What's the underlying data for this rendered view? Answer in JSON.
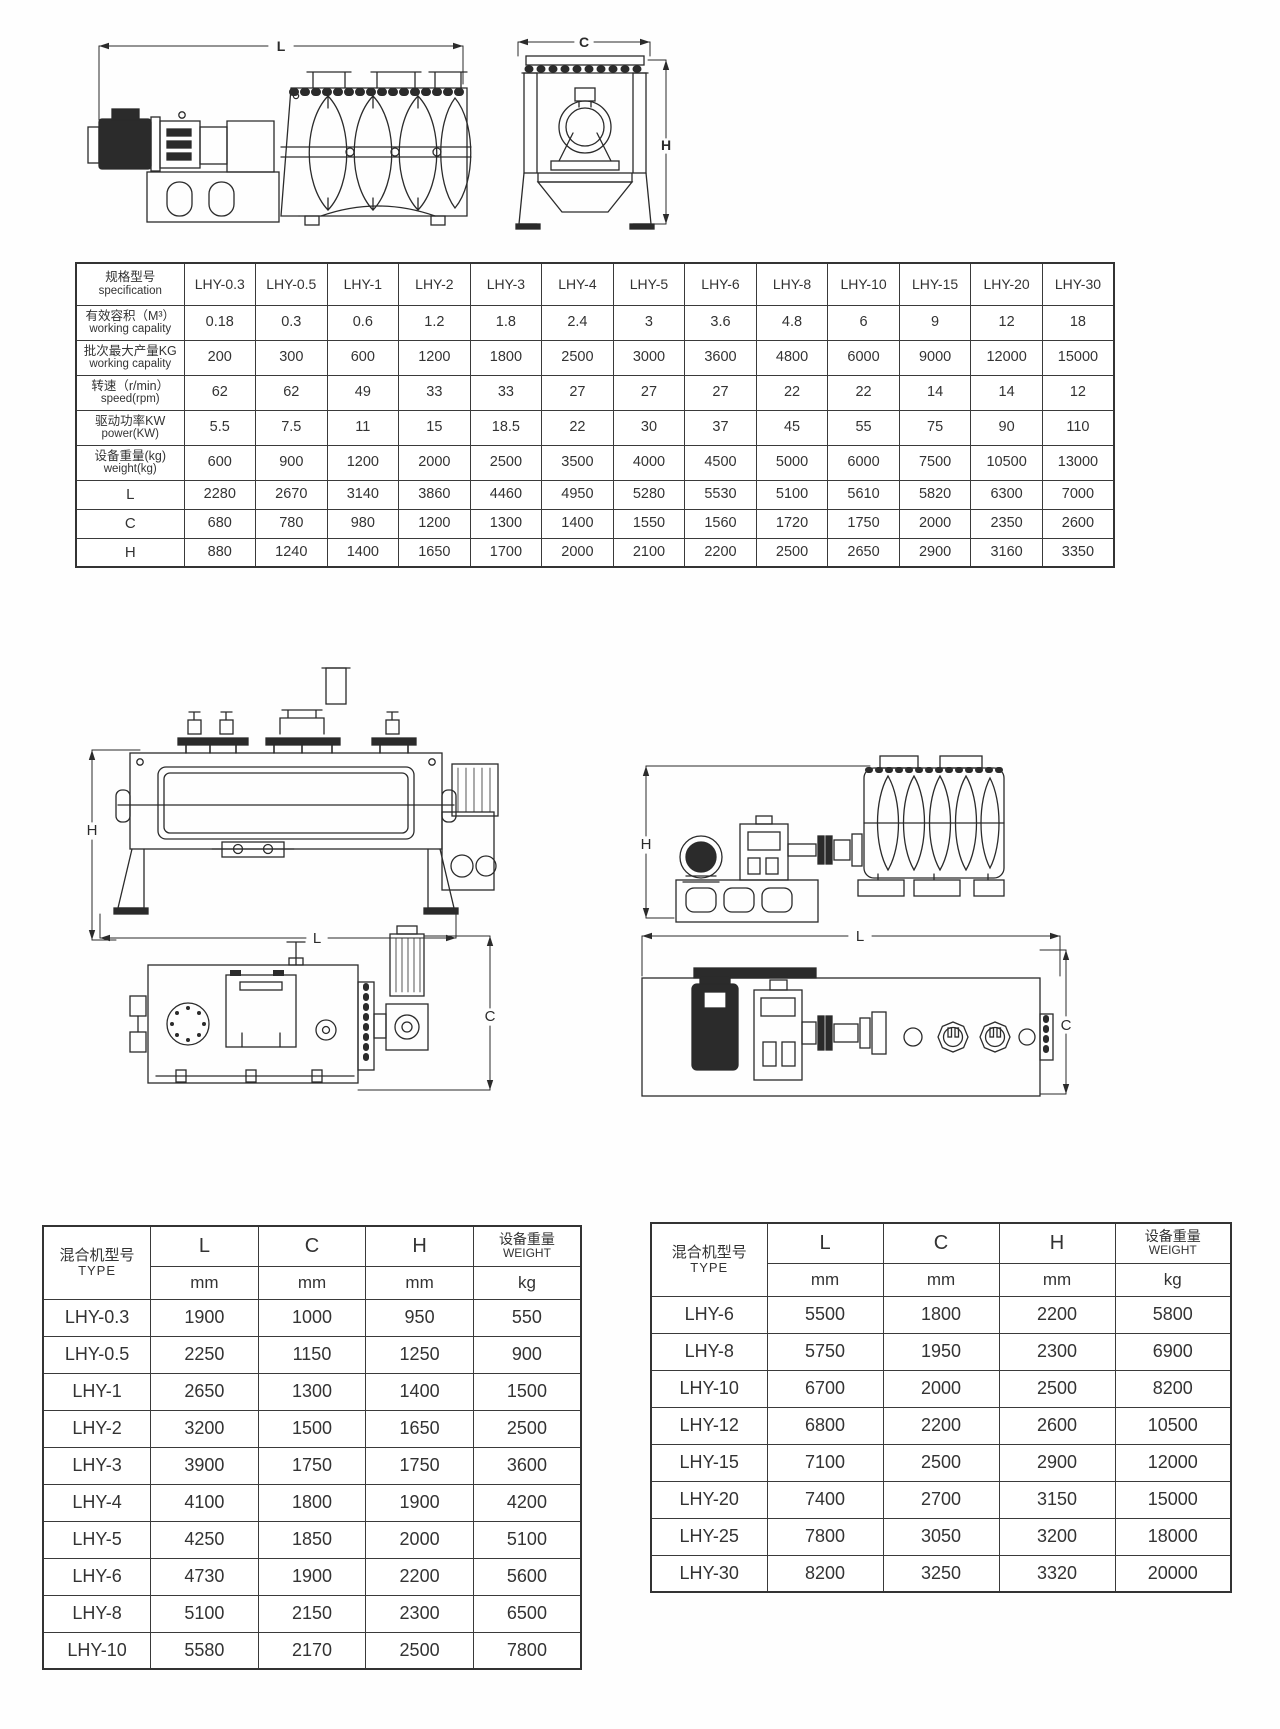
{
  "page": {
    "background": "#ffffff",
    "ink": "#2b2b2b"
  },
  "drawings": {
    "dim_labels": {
      "L": "L",
      "C": "C",
      "H": "H"
    }
  },
  "spec_table": {
    "header": {
      "zh": "规格型号",
      "en": "specification"
    },
    "models": [
      "LHY-0.3",
      "LHY-0.5",
      "LHY-1",
      "LHY-2",
      "LHY-3",
      "LHY-4",
      "LHY-5",
      "LHY-6",
      "LHY-8",
      "LHY-10",
      "LHY-15",
      "LHY-20",
      "LHY-30"
    ],
    "rows": [
      {
        "zh": "有效容积（M³）",
        "en": "working capality",
        "values": [
          "0.18",
          "0.3",
          "0.6",
          "1.2",
          "1.8",
          "2.4",
          "3",
          "3.6",
          "4.8",
          "6",
          "9",
          "12",
          "18"
        ]
      },
      {
        "zh": "批次最大产量KG",
        "en": "working capality",
        "values": [
          "200",
          "300",
          "600",
          "1200",
          "1800",
          "2500",
          "3000",
          "3600",
          "4800",
          "6000",
          "9000",
          "12000",
          "15000"
        ]
      },
      {
        "zh": "转速（r/min）",
        "en": "speed(rpm)",
        "values": [
          "62",
          "62",
          "49",
          "33",
          "33",
          "27",
          "27",
          "27",
          "22",
          "22",
          "14",
          "14",
          "12"
        ]
      },
      {
        "zh": "驱动功率KW",
        "en": "power(KW)",
        "values": [
          "5.5",
          "7.5",
          "11",
          "15",
          "18.5",
          "22",
          "30",
          "37",
          "45",
          "55",
          "75",
          "90",
          "110"
        ]
      },
      {
        "zh": "设备重量(kg)",
        "en": "weight(kg)",
        "values": [
          "600",
          "900",
          "1200",
          "2000",
          "2500",
          "3500",
          "4000",
          "4500",
          "5000",
          "6000",
          "7500",
          "10500",
          "13000"
        ]
      },
      {
        "zh": "L",
        "en": "",
        "values": [
          "2280",
          "2670",
          "3140",
          "3860",
          "4460",
          "4950",
          "5280",
          "5530",
          "5100",
          "5610",
          "5820",
          "6300",
          "7000"
        ]
      },
      {
        "zh": "C",
        "en": "",
        "values": [
          "680",
          "780",
          "980",
          "1200",
          "1300",
          "1400",
          "1550",
          "1560",
          "1720",
          "1750",
          "2000",
          "2350",
          "2600"
        ]
      },
      {
        "zh": "H",
        "en": "",
        "values": [
          "880",
          "1240",
          "1400",
          "1650",
          "1700",
          "2000",
          "2100",
          "2200",
          "2500",
          "2650",
          "2900",
          "3160",
          "3350"
        ]
      }
    ]
  },
  "dim_table_left": {
    "header": {
      "type_zh": "混合机型号",
      "type_en": "TYPE",
      "col_l": "L",
      "col_c": "C",
      "col_h": "H",
      "weight_zh": "设备重量",
      "weight_en": "WEIGHT",
      "units": [
        "mm",
        "mm",
        "mm",
        "kg"
      ]
    },
    "rows": [
      [
        "LHY-0.3",
        "1900",
        "1000",
        "950",
        "550"
      ],
      [
        "LHY-0.5",
        "2250",
        "1150",
        "1250",
        "900"
      ],
      [
        "LHY-1",
        "2650",
        "1300",
        "1400",
        "1500"
      ],
      [
        "LHY-2",
        "3200",
        "1500",
        "1650",
        "2500"
      ],
      [
        "LHY-3",
        "3900",
        "1750",
        "1750",
        "3600"
      ],
      [
        "LHY-4",
        "4100",
        "1800",
        "1900",
        "4200"
      ],
      [
        "LHY-5",
        "4250",
        "1850",
        "2000",
        "5100"
      ],
      [
        "LHY-6",
        "4730",
        "1900",
        "2200",
        "5600"
      ],
      [
        "LHY-8",
        "5100",
        "2150",
        "2300",
        "6500"
      ],
      [
        "LHY-10",
        "5580",
        "2170",
        "2500",
        "7800"
      ]
    ]
  },
  "dim_table_right": {
    "header": {
      "type_zh": "混合机型号",
      "type_en": "TYPE",
      "col_l": "L",
      "col_c": "C",
      "col_h": "H",
      "weight_zh": "设备重量",
      "weight_en": "WEIGHT",
      "units": [
        "mm",
        "mm",
        "mm",
        "kg"
      ]
    },
    "rows": [
      [
        "LHY-6",
        "5500",
        "1800",
        "2200",
        "5800"
      ],
      [
        "LHY-8",
        "5750",
        "1950",
        "2300",
        "6900"
      ],
      [
        "LHY-10",
        "6700",
        "2000",
        "2500",
        "8200"
      ],
      [
        "LHY-12",
        "6800",
        "2200",
        "2600",
        "10500"
      ],
      [
        "LHY-15",
        "7100",
        "2500",
        "2900",
        "12000"
      ],
      [
        "LHY-20",
        "7400",
        "2700",
        "3150",
        "15000"
      ],
      [
        "LHY-25",
        "7800",
        "3050",
        "3200",
        "18000"
      ],
      [
        "LHY-30",
        "8200",
        "3250",
        "3320",
        "20000"
      ]
    ]
  }
}
